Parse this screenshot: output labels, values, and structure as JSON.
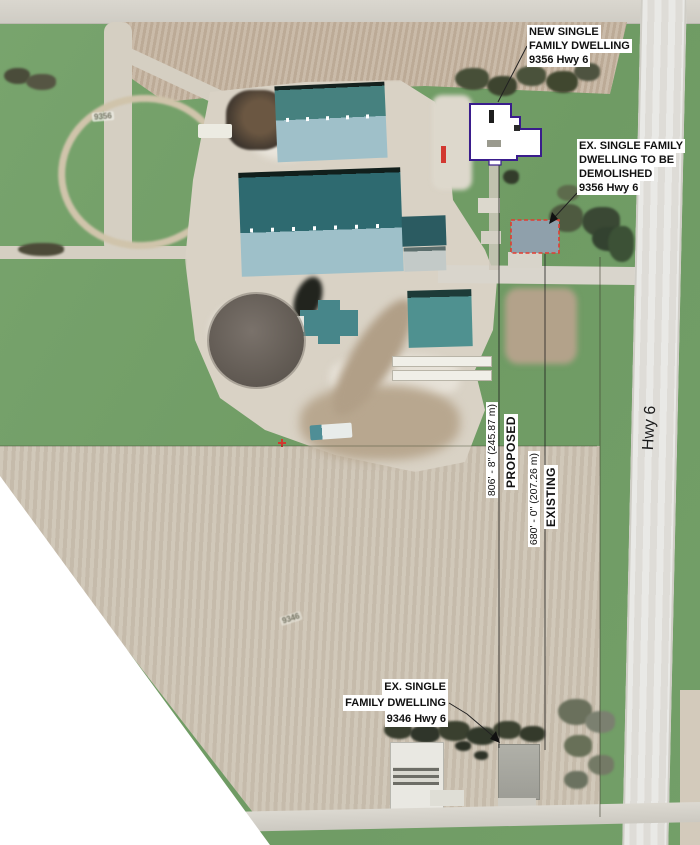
{
  "page": {
    "type": "aerial site plan with annotations"
  },
  "highway": {
    "label": "Hwy 6"
  },
  "labels": {
    "new_dwelling": {
      "lines": [
        "NEW SINGLE",
        "FAMILY DWELLING",
        "9356 Hwy 6"
      ]
    },
    "demolish_dwelling": {
      "lines": [
        "EX. SINGLE FAMILY",
        "DWELLING TO BE",
        "DEMOLISHED",
        "9356 Hwy 6"
      ]
    },
    "south_dwelling": {
      "lines": [
        "EX. SINGLE",
        "FAMILY DWELLING",
        "9346 Hwy 6"
      ]
    }
  },
  "dimensions": {
    "proposed": {
      "value": "806' - 8\" (245.87 m)",
      "tag": "PROPOSED"
    },
    "existing": {
      "value": "680' - 0\" (207.26 m)",
      "tag": "EXISTING"
    }
  },
  "parcel_labels": {
    "north": "9356",
    "south": "9346"
  },
  "colors": {
    "dwelling_outline": "#3a1d8c",
    "demolish_outline": "#e23c31",
    "barn_roof_dark": "#2e6a70",
    "barn_roof_light": "#9ec0c9",
    "grass": "#74a069",
    "plowed_field": "#c4b39f",
    "tilled_field": "#ccc2b2",
    "road": "#e4e4e1"
  }
}
